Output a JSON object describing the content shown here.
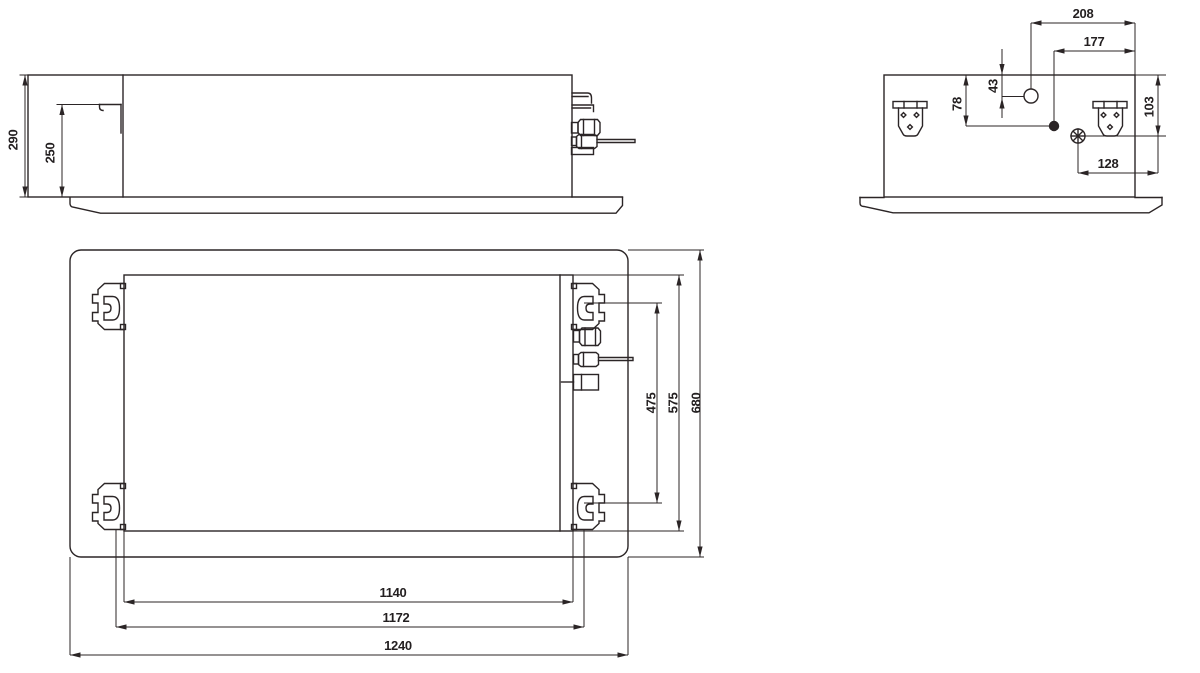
{
  "diagram": {
    "background": "#ffffff",
    "line_color": "#2b2526",
    "views": {
      "front": {
        "dims": {
          "d290": "290",
          "d250": "250"
        }
      },
      "side": {
        "dims": {
          "d208": "208",
          "d177": "177",
          "d43": "43",
          "d78": "78",
          "d103": "103",
          "d128": "128"
        }
      },
      "plan": {
        "dims": {
          "d475": "475",
          "d575": "575",
          "d680": "680",
          "d1140": "1140",
          "d1172": "1172",
          "d1240": "1240"
        }
      }
    }
  }
}
